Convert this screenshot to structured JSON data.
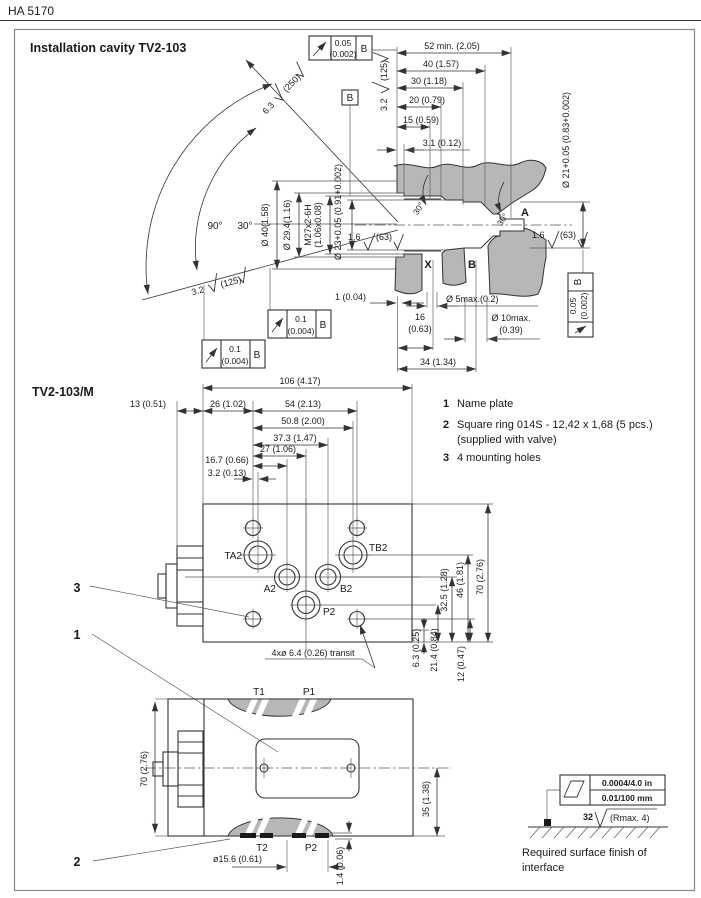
{
  "page": {
    "code": "HA 5170"
  },
  "cavity": {
    "title": "Installation cavity TV2-103",
    "dims_top": [
      "52 min. (2.05)",
      "40 (1.57)",
      "30 (1.18)",
      "20 (0.79)",
      "15 (0.59)",
      "3.1 (0.12)"
    ],
    "vdims": {
      "d40": "Ø 40(1.58)",
      "d294": "Ø 29.4(1.16)",
      "m27a": "M27x2-6H",
      "m27b": "(1.06x0.08)",
      "d23": "Ø 23+0.05 (0.91+0.002)"
    },
    "d21": "Ø 21+0.05 (0.83+0.002)",
    "a90": "90°",
    "a30": "30°",
    "a30b": "30°",
    "a30c": "30°",
    "fin": {
      "f63": "6.3",
      "f250": "(250)",
      "f32": "3.2",
      "f125": "(125)",
      "f16": "1.6",
      "f63b": "(63)"
    },
    "ports": {
      "a": "A",
      "x": "X",
      "b": "B"
    },
    "tol": {
      "v05": "0.05",
      "v002": "(0.002)",
      "v1": "0.1",
      "v004": "(0.004)",
      "b": "B"
    },
    "bdims": {
      "d1": "1 (0.04)",
      "d5": "Ø 5max.(0.2)",
      "d16": "16",
      "d16i": "(0.63)",
      "d10": "Ø 10max.",
      "d10i": "(0.39)",
      "d34": "34 (1.34)"
    }
  },
  "valve": {
    "title": "TV2-103/M",
    "notes": [
      {
        "n": "1",
        "t": "Name plate"
      },
      {
        "n": "2",
        "t": "Square ring 014S - 12,42 x 1,68 (5 pcs.)",
        "t2": "(supplied with valve)"
      },
      {
        "n": "3",
        "t": "4 mounting holes"
      }
    ],
    "tdims": [
      "106 (4.17)",
      "13 (0.51)",
      "26 (1.02)",
      "54 (2.13)",
      "50.8 (2.00)",
      "37.3 (1.47)",
      "27 (1.06)",
      "16.7 (0.66)",
      "3.2 (0.13)"
    ],
    "rdims": [
      "6.3 (0.25)",
      "21.4 (0.84)",
      "32.5 (1.28)",
      "46 (1.81)",
      "70 (2.76)",
      "12 (0.47)"
    ],
    "ports": {
      "ta2": "TA2",
      "tb2": "TB2",
      "a2": "A2",
      "b2": "B2",
      "p2": "P2"
    },
    "transit": "4xø 6.4 (0.26) transit",
    "c1": "1",
    "c2": "2",
    "c3": "3"
  },
  "front": {
    "t1": "T1",
    "p1": "P1",
    "t2": "T2",
    "p2": "P2",
    "d70": "70 (2.76)",
    "d35": "35 (1.38)",
    "d156": "ø15.6 (0.61)",
    "d14": "1.4 (0.06)"
  },
  "finish": {
    "inch": "0.0004/4.0 in",
    "mm": "0.01/100 mm",
    "r": "32",
    "rmax": "(Rmax. 4)",
    "cap1": "Required surface finish of",
    "cap2": "interface"
  }
}
